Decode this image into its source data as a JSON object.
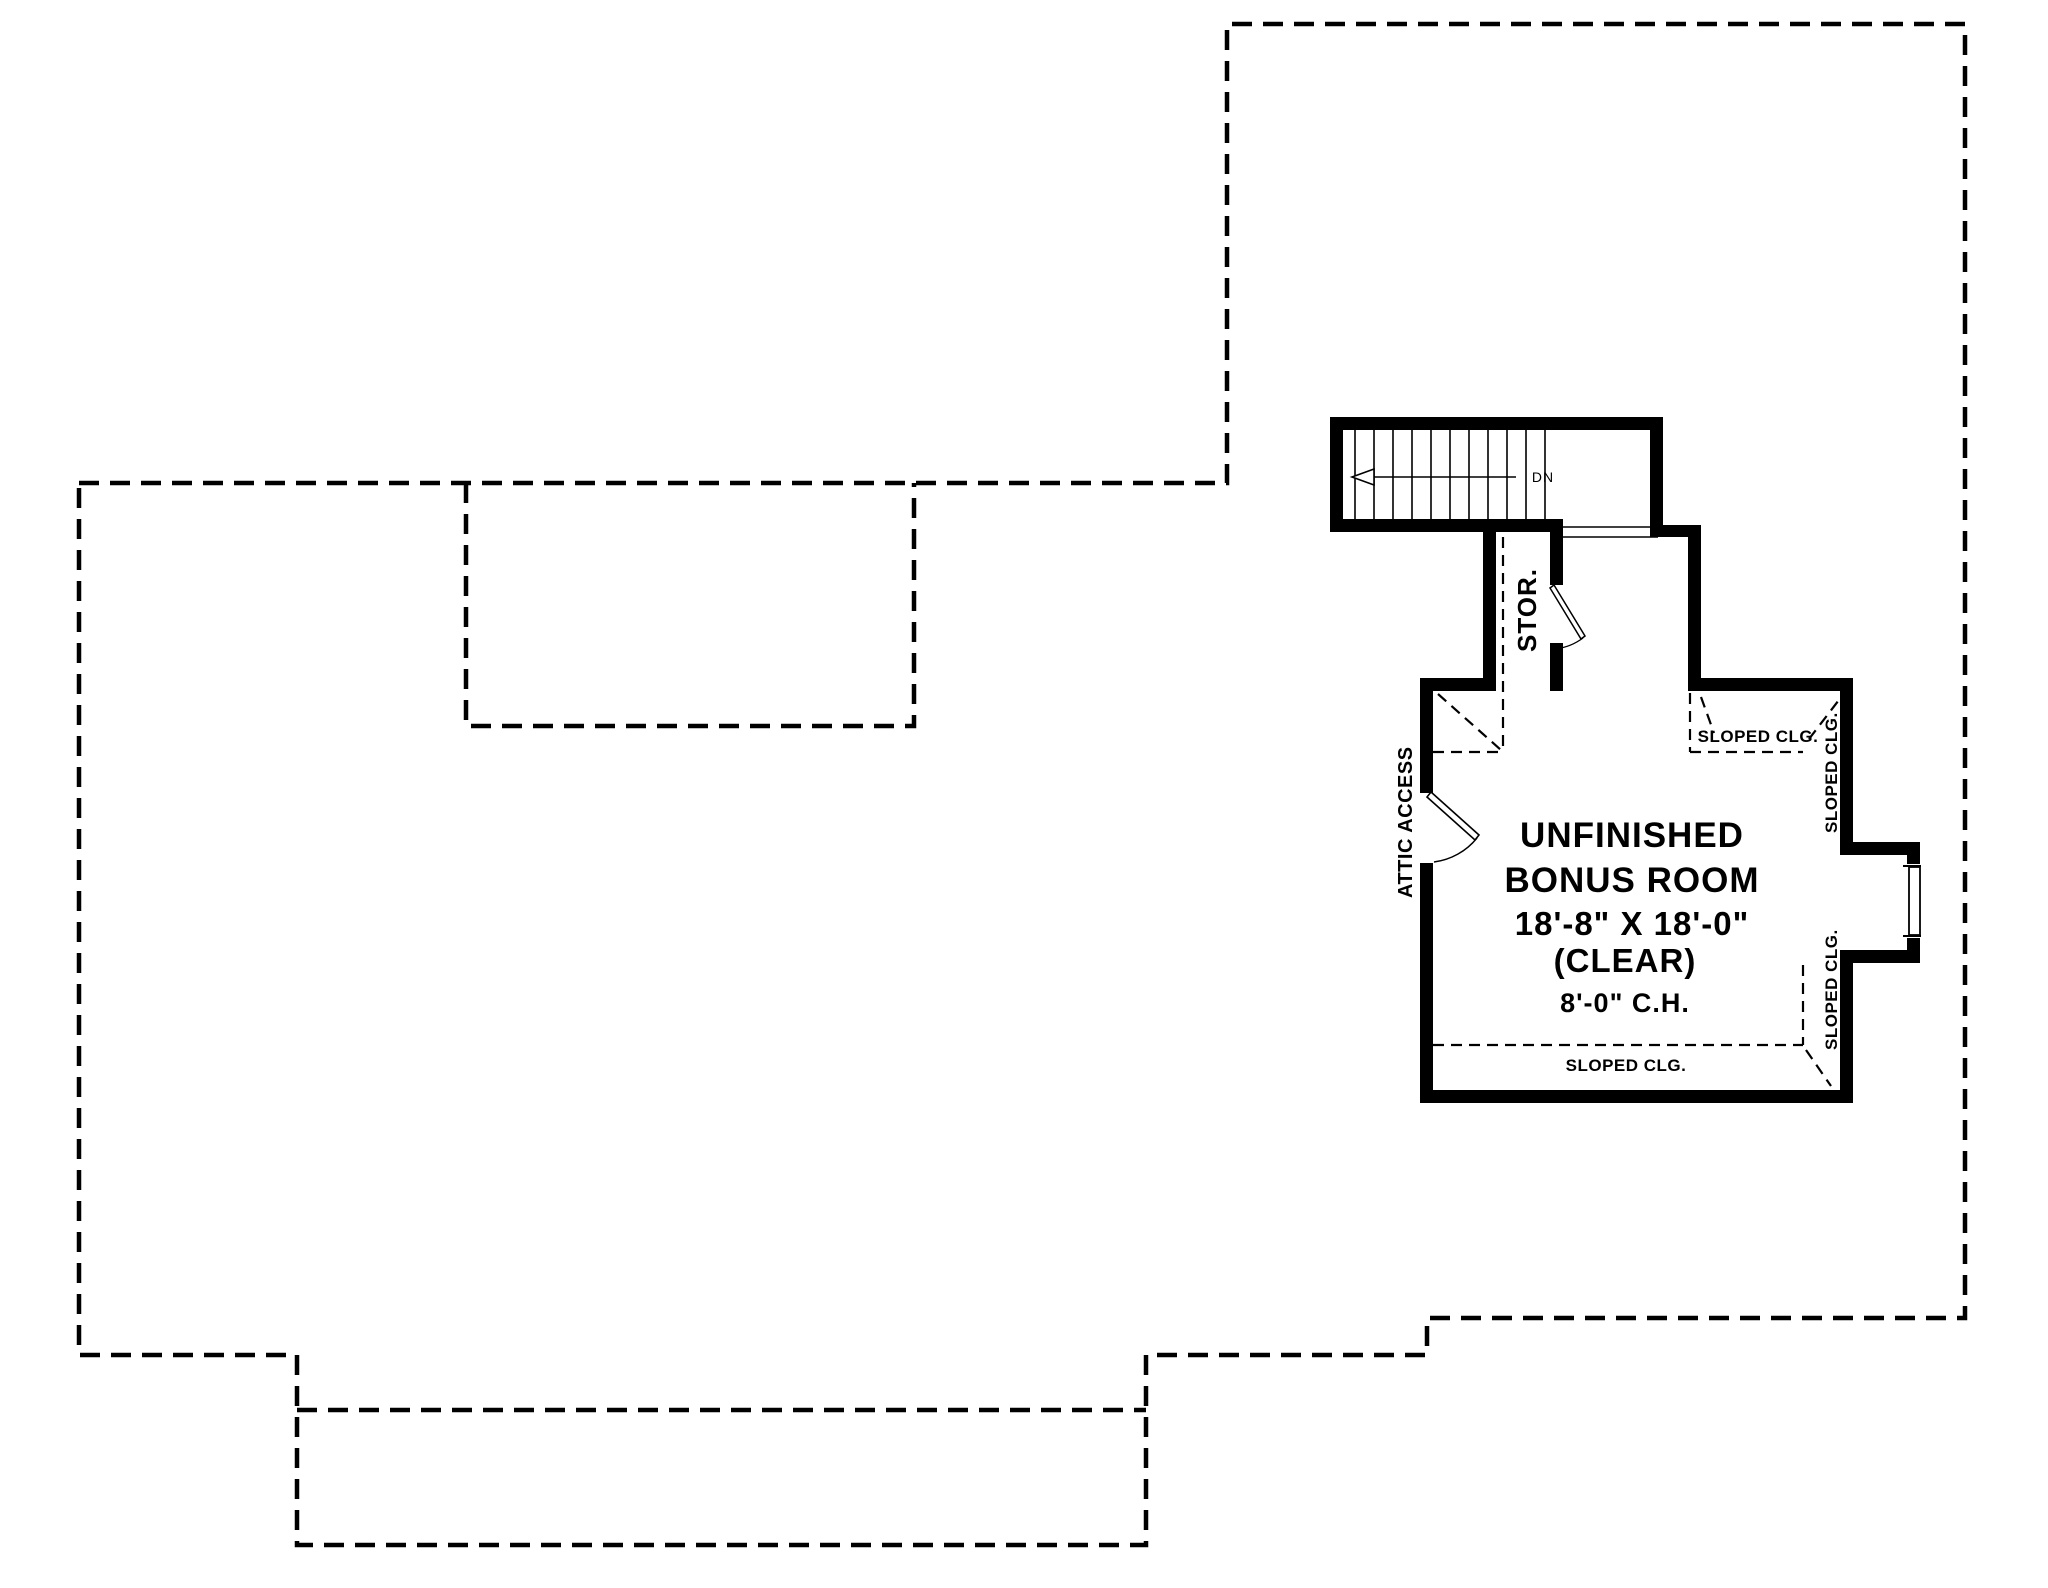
{
  "page": {
    "background_color": "#ffffff",
    "line_color": "#000000"
  },
  "plan": {
    "room": {
      "name_line1": "UNFINISHED",
      "name_line2": "BONUS ROOM",
      "dimensions": "18'-8\" X 18'-0\"",
      "clear_note": "(CLEAR)",
      "ceiling_height": "8'-0\" C.H."
    },
    "labels": {
      "storage": "STOR.",
      "attic_access": "ATTIC ACCESS",
      "stairs_direction": "DN",
      "sloped_ceiling": "SLOPED CLG."
    },
    "icons": {
      "stairs_down_arrow": "left-pointing open arrow along stair run"
    }
  }
}
